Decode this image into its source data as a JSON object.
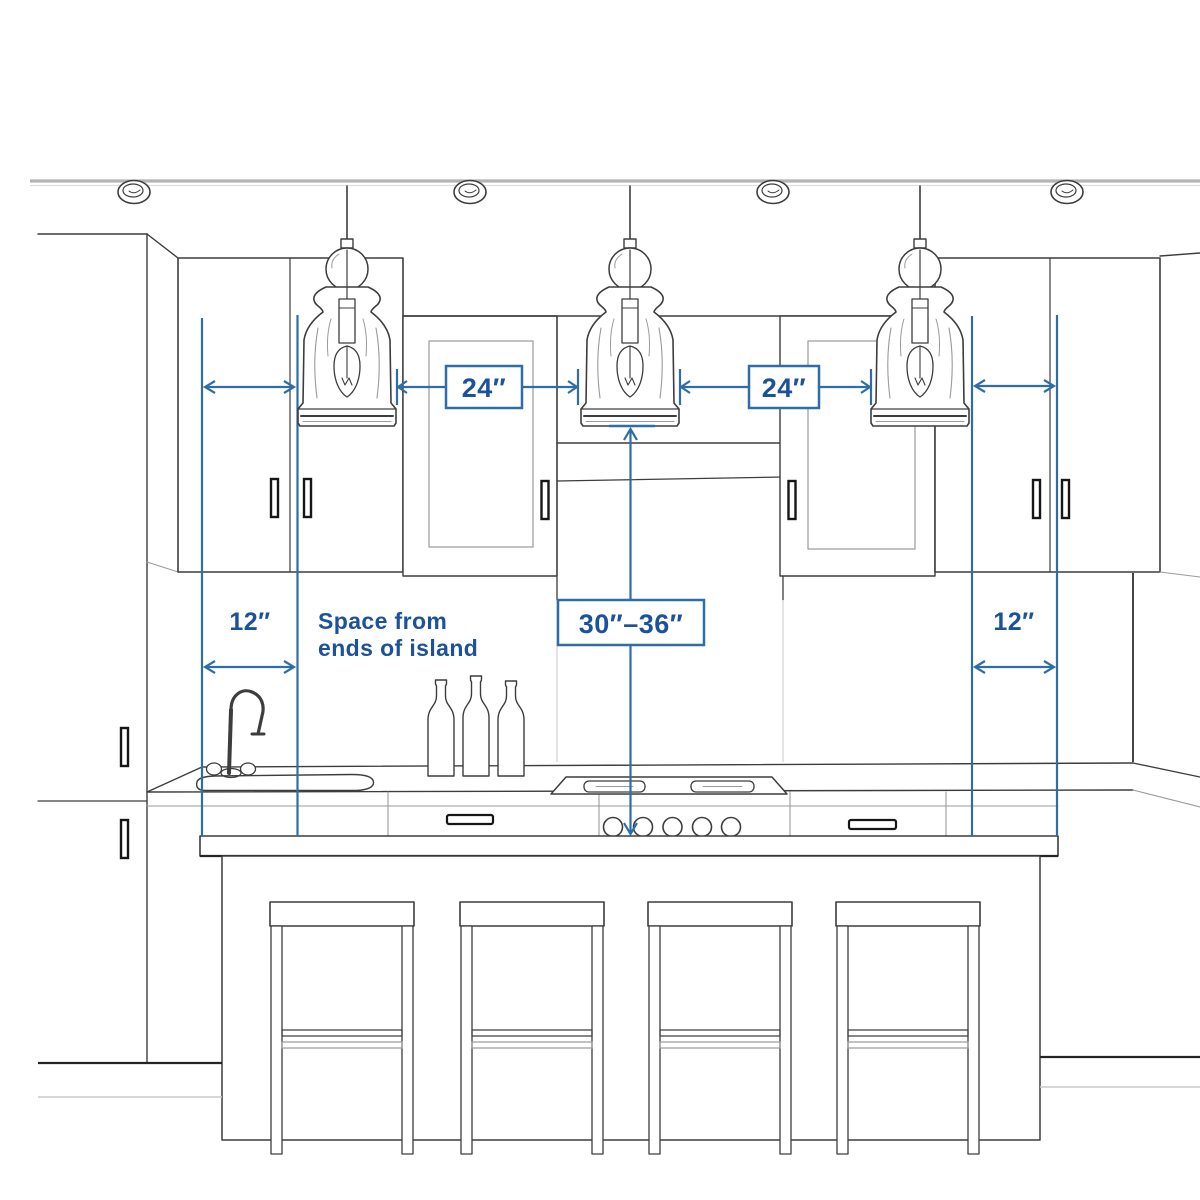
{
  "annotations": {
    "spacing_left": "24″",
    "spacing_right": "24″",
    "end_left": "12″",
    "end_right": "12″",
    "height_range": "30″–36″",
    "note_line1": "Space from",
    "note_line2": "ends of island"
  },
  "colors": {
    "annotation_line": "#2e6da8",
    "annotation_text": "#1b5299",
    "sketch_line": "#3d3d3d"
  },
  "scene": {
    "pendant_lights": 3,
    "recessed_lights": 4,
    "bar_stools": 4,
    "bottles": 3,
    "cooktop_knobs": 5
  }
}
